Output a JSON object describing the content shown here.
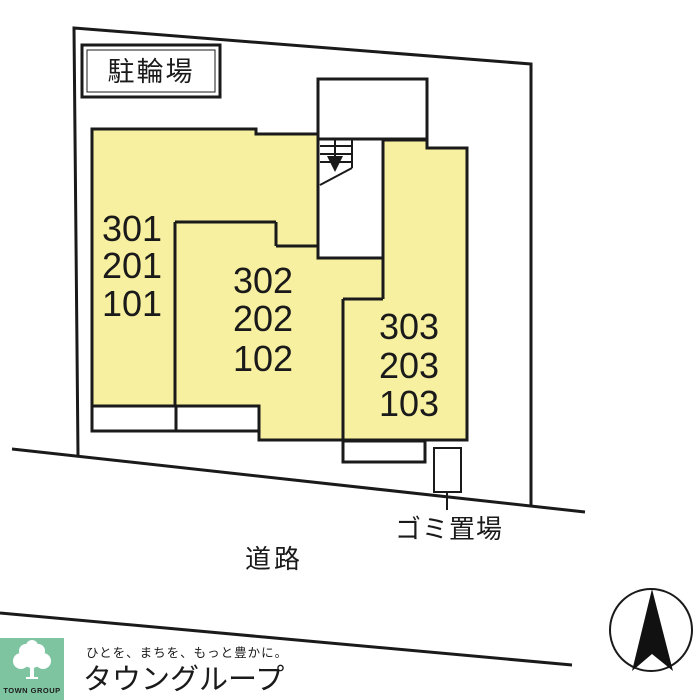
{
  "colors": {
    "building_fill": "#F7F0A0",
    "line": "#1A1A1A",
    "logo_badge_green": "#7FC4A0",
    "logo_brand_green": "#5EBF92",
    "logo_tagline_green": "#74AF9C"
  },
  "site_plan": {
    "labels": {
      "bicycle_parking": "駐輪場",
      "garbage": "ゴミ置場",
      "road": "道路"
    },
    "unit_stacks": {
      "left": [
        "301",
        "201",
        "101"
      ],
      "middle": [
        "302",
        "202",
        "102"
      ],
      "right": [
        "303",
        "203",
        "103"
      ]
    }
  },
  "logo": {
    "badge_text": "TOWN GROUP",
    "tagline": "ひとを、まちを、もっと豊かに。",
    "brand": "タウングループ"
  }
}
